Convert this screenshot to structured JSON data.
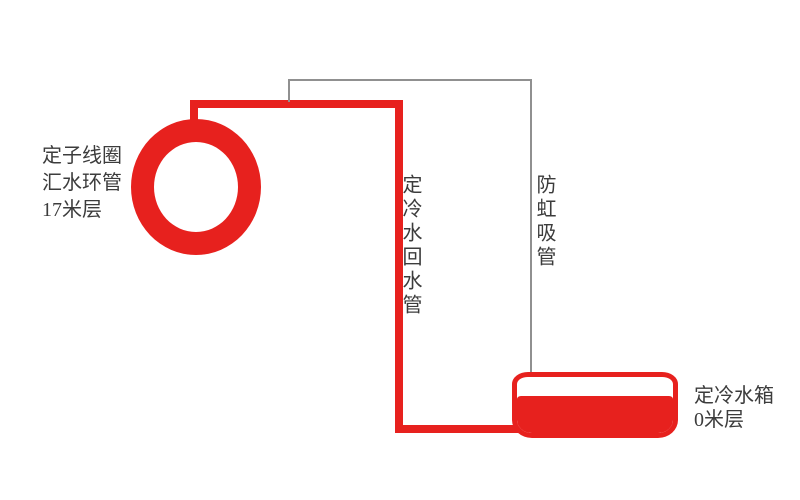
{
  "diagram": {
    "labels": {
      "ring": {
        "line1": "定子线圈",
        "line2": "汇水环管",
        "line3": "17米层"
      },
      "return_pipe": "定冷水回水管",
      "anti_siphon": "防虹吸管",
      "tank": {
        "line1": "定冷水箱",
        "line2": "0米层"
      }
    },
    "colors": {
      "pipe_red": "#e7211e",
      "anti_siphon_gray": "#909090",
      "text": "#3c3c3c",
      "background": "#ffffff"
    }
  }
}
